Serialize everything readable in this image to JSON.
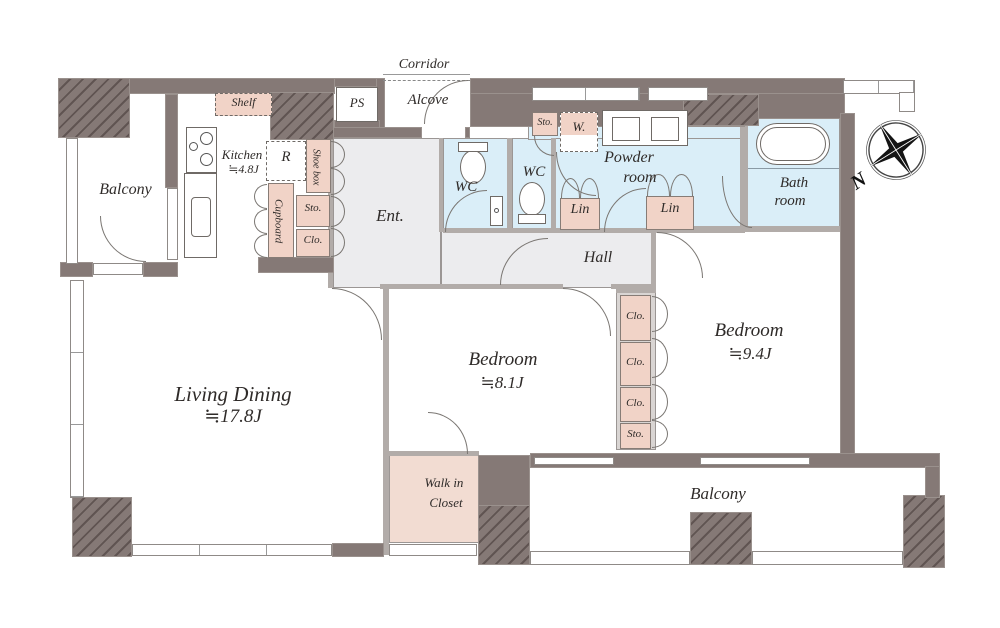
{
  "labels": {
    "balcony": "Balcony",
    "corridor": "Corridor",
    "alcove": "Alcove",
    "ps": "PS",
    "shelf": "Shelf",
    "kitchen": "Kitchen",
    "kitchen_size": "≒4.8J",
    "fridge": "R",
    "shoe_box": "Shoe box",
    "cupboard": "Cupboard",
    "sto": "Sto.",
    "clo": "Clo.",
    "ent": "Ent.",
    "wc": "WC",
    "washer": "W.",
    "powder_1": "Powder",
    "powder_2": "room",
    "lin": "Lin",
    "bath_1": "Bath",
    "bath_2": "room",
    "hall": "Hall",
    "living": "Living Dining",
    "living_size": "≒17.8J",
    "bedroom": "Bedroom",
    "bedroom1_size": "≒8.1J",
    "bedroom2_size": "≒9.4J",
    "wic_1": "Walk in",
    "wic_2": "Closet",
    "compass_n": "N"
  },
  "colors": {
    "wall": "#857976",
    "storage_pink": "#f1d3c7",
    "wet_blue": "#daeef8",
    "floor_gray": "#ececee",
    "line": "#555555"
  }
}
